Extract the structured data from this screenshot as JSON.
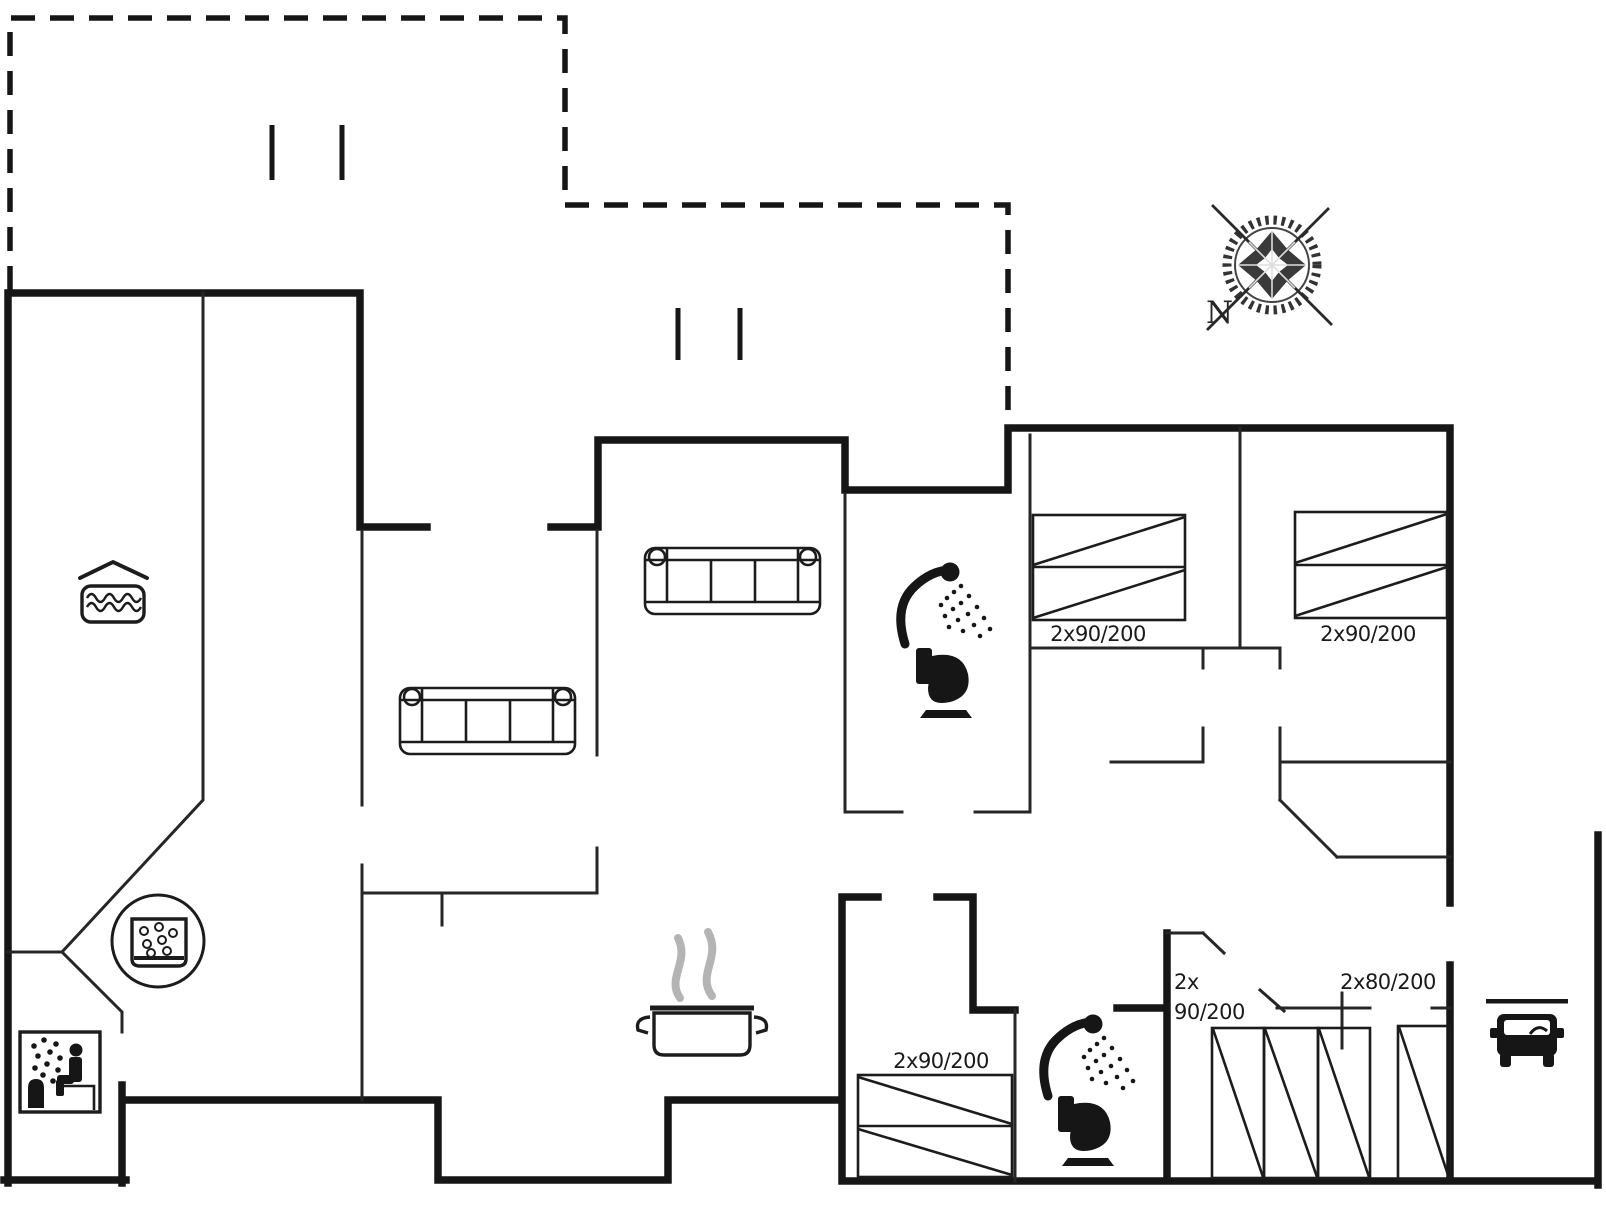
{
  "page": {
    "title": "Holiday home floor plan",
    "type": "architectural floor plan drawing"
  },
  "colors": {
    "background": "#ffffff",
    "walls": "#161616",
    "thin_lines": "#262626",
    "furniture_lines": "#1c1c1c",
    "steam_gray": "#b4b4b4",
    "compass_gray": "#333333"
  },
  "compass": {
    "north_label": "N"
  },
  "bed_size_labels": {
    "bedroom_top_1": "2x90/200",
    "bedroom_top_2": "2x90/200",
    "bedroom_bottom_center": "2x90/200",
    "bedroom_bottom_right_line1": "2x",
    "bedroom_bottom_right_line2": "90/200",
    "bedroom_bottom_right_wide": "2x80/200"
  },
  "icons": [
    {
      "name": "compass-rose-icon",
      "meaning": "north orientation"
    },
    {
      "name": "pool-icon",
      "meaning": "indoor swimming pool"
    },
    {
      "name": "whirlpool-icon",
      "meaning": "whirlpool / hot tub"
    },
    {
      "name": "sauna-icon",
      "meaning": "sauna"
    },
    {
      "name": "shower-icon",
      "meaning": "shower"
    },
    {
      "name": "toilet-icon",
      "meaning": "toilet"
    },
    {
      "name": "cooking-pot-icon",
      "meaning": "kitchen / stove"
    },
    {
      "name": "steam-icon",
      "meaning": "steam over pot"
    },
    {
      "name": "car-icon",
      "meaning": "carport / parking"
    },
    {
      "name": "window-marks",
      "meaning": "window tick marks"
    },
    {
      "name": "terrace-dashed-outline",
      "meaning": "terrace / roofed outdoor area"
    }
  ],
  "furniture": [
    {
      "name": "sofa",
      "count": 2
    },
    {
      "name": "double-bed",
      "count": 3
    },
    {
      "name": "single-mattress",
      "count": 4
    }
  ]
}
